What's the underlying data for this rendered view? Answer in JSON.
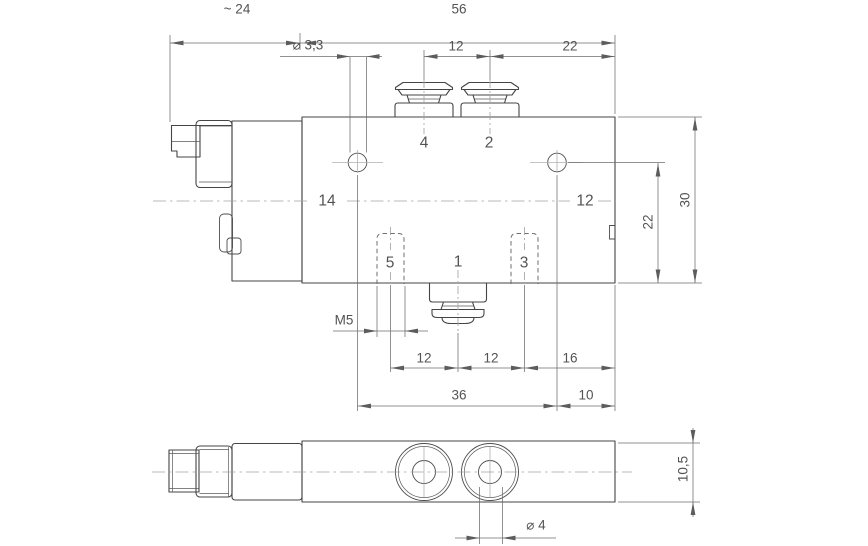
{
  "drawing": {
    "colors": {
      "ink": "#454545",
      "dimension": "#6e6e6e",
      "centerline": "#a4a4a4",
      "background": "#ffffff"
    },
    "front_view": {
      "port_labels": {
        "p4": "4",
        "p2": "2",
        "p14": "14",
        "p12": "12",
        "p5": "5",
        "p1": "1",
        "p3": "3"
      },
      "dimensions": {
        "connector_width": "~ 24",
        "body_width": "56",
        "hole_diameter": "⌀ 3,3",
        "port_spacing_top": "12",
        "port2_to_edge": "22",
        "thread_size": "M5",
        "spacing_5_1": "12",
        "spacing_1_3": "12",
        "spacing_3_edge": "16",
        "hole_spacing": "36",
        "hole_to_edge": "10",
        "hole_center_height": "22",
        "body_height": "30"
      }
    },
    "bottom_view": {
      "dimensions": {
        "body_depth": "10,5",
        "port_bore": "⌀ 4"
      }
    }
  }
}
